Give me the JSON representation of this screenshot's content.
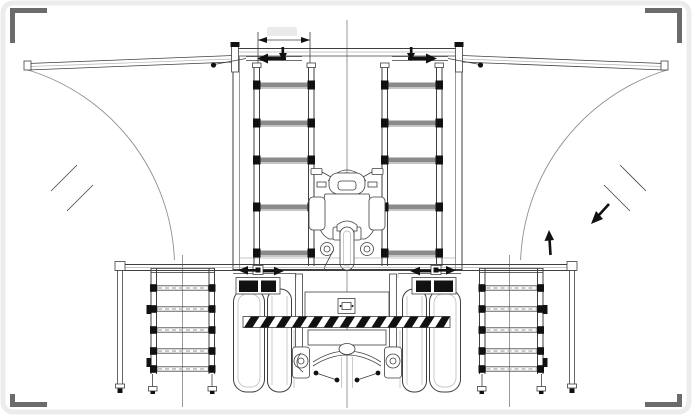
{
  "meta": {
    "type": "cad-technical-drawing",
    "view": "rear-elevation",
    "subject": "box truck with fold-out side wing panels shown open, swing arcs, interior ladder racks, stowed motorcycle, fold-down shelf racks and rear axle detail"
  },
  "canvas": {
    "width": 692,
    "height": 415,
    "background": "#ffffff"
  },
  "colors": {
    "frame_border": "#ececec",
    "corner_mark": "#6b6b6b",
    "line_primary": "#3f3f3f",
    "line_secondary": "#8f8f8f",
    "line_light": "#b5b5b5",
    "solid_black": "#111111",
    "rung_fill": "#8a8a8a",
    "faint_text": "#dcdcdc"
  },
  "annotations": {
    "dimension_top": {
      "label": "",
      "x1": 258,
      "x2": 310,
      "y": 40,
      "note": "dimension text faded to near-white, illegible"
    },
    "swing_arc_left": {
      "cx": 235,
      "cy": 62,
      "r": 207.2,
      "a0": 177.8,
      "a1": 107,
      "sweep": 1,
      "break_marks": 2
    },
    "swing_arc_right": {
      "cx": 460,
      "cy": 62,
      "r": 207.2,
      "a0": 2.2,
      "a1": 73,
      "sweep": 0,
      "break_marks": 2,
      "direction_arrows": 2
    }
  },
  "racks_upper": {
    "rung_ys": [
      85,
      123,
      160,
      207,
      253
    ],
    "left": {
      "bar_x": 260,
      "bar_w": 48,
      "block_lx": 253,
      "block_rx": 307.5
    },
    "right": {
      "bar_x": 388,
      "bar_w": 48,
      "block_lx": 381,
      "block_rx": 435.5
    }
  },
  "racks_lower": {
    "shelf_ys": [
      288,
      309,
      330,
      351,
      369
    ],
    "left": {
      "shelf_x": 157,
      "shelf_w": 51.5,
      "block_lx": 150,
      "block_rx": 208.5
    },
    "right": {
      "shelf_x": 485.5,
      "shelf_w": 51.5,
      "block_lx": 478.5,
      "block_rx": 537
    }
  },
  "hazard_bar": {
    "segments": [
      {
        "x": 243,
        "y": 316.5,
        "w": 207,
        "h": 11,
        "stripes": 13
      }
    ],
    "slant": 7,
    "band_w": 8.5
  },
  "components": {
    "wing_panel_left": {
      "state": "open",
      "tip_x": 28,
      "hinge_x": 233
    },
    "wing_panel_right": {
      "state": "open",
      "tip_x": 664,
      "hinge_x": 462
    },
    "ladder_rack_upper_left": {
      "rungs": 5
    },
    "ladder_rack_upper_right": {
      "rungs": 5
    },
    "shelf_rack_lower_left": {
      "shelves": 5
    },
    "shelf_rack_lower_right": {
      "shelves": 5
    },
    "wheels": {
      "left": "dual",
      "right": "dual"
    },
    "motorcycle": {
      "position": "center",
      "stowed": true
    },
    "deck_platform": {
      "x1": 116,
      "x2": 576,
      "y": 265
    }
  }
}
